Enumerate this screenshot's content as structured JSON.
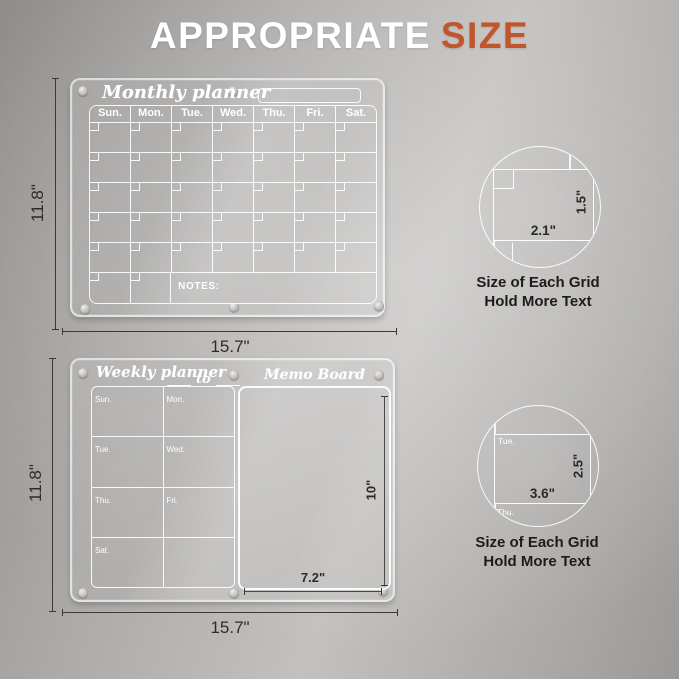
{
  "page_title": {
    "word_primary": "APPROPRIATE",
    "word_accent": "SIZE"
  },
  "colors": {
    "accent_orange": "#c0562e",
    "dimension_line": "#3a3938",
    "board_line": "#ffffff"
  },
  "monthly_board": {
    "title": "Monthly planner",
    "day_headers": [
      "Sun.",
      "Mon.",
      "Tue.",
      "Wed.",
      "Thu.",
      "Fri.",
      "Sat."
    ],
    "notes_label": "NOTES:",
    "width_dim": "15.7\"",
    "height_dim": "11.8\""
  },
  "weekly_board": {
    "title": "Weekly planner",
    "range_separator": "to",
    "memo_title": "Memo Board",
    "day_cells": [
      "Sun.",
      "Mon.",
      "Tue.",
      "Wed.",
      "Thu.",
      "Fri.",
      "Sat."
    ],
    "memo_width_dim": "7.2\"",
    "memo_height_dim": "10\"",
    "width_dim": "15.7\"",
    "height_dim": "11.8\""
  },
  "monthly_grid_inset": {
    "width_dim": "2.1\"",
    "height_dim": "1.5\"",
    "caption_line1": "Size of Each Grid",
    "caption_line2": "Hold More Text"
  },
  "weekly_grid_inset": {
    "width_dim": "3.6\"",
    "height_dim": "2.5\"",
    "label_tue": "Tue.",
    "label_wed": "We",
    "label_thu": "Thu.",
    "caption_line1": "Size of Each Grid",
    "caption_line2": "Hold More Text"
  }
}
